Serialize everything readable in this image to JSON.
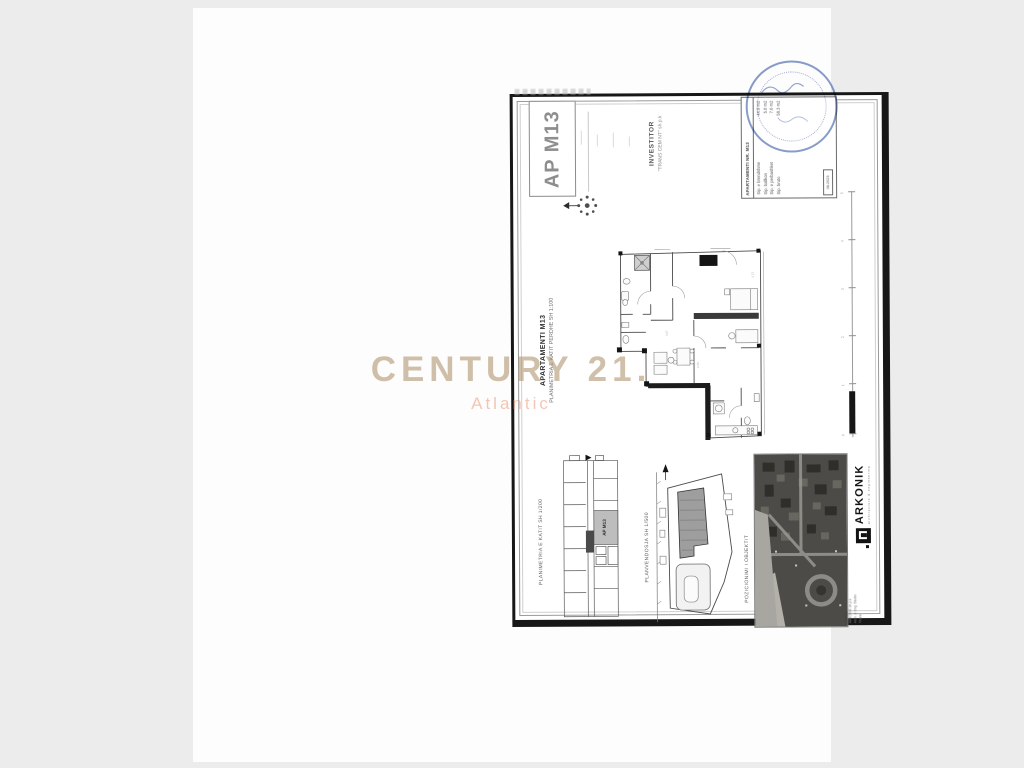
{
  "watermark": {
    "brand": "CENTURY 21.",
    "sub": "Atlantic"
  },
  "badge": "AP M13",
  "investor": {
    "label": "INVESTITOR",
    "name": "\"TRANS CEM NT\" sh.p.k"
  },
  "title_block": {
    "heading": "APARTAMENTI NR. M13",
    "rows": [
      {
        "label": "Sip. e brendshme",
        "value": "44.9 m2"
      },
      {
        "label": "Sip. ballkon",
        "value": "5.8 m2"
      },
      {
        "label": "Sip. e perbashket",
        "value": "7.6 m2"
      },
      {
        "label": "Sip. bruto",
        "value": "58.3 m2"
      }
    ],
    "date_box": "06.2023"
  },
  "main_plan": {
    "title": "APARTAMENTI M13",
    "subtitle": "PLANIMETRIA E KATIT PERDHE SH 1:100"
  },
  "scale_bar": {
    "labels": [
      "5",
      "4",
      "3",
      "2",
      "1",
      "0"
    ]
  },
  "key_plan": {
    "label": "PLANIMETRIA E KATIT SH 1/200",
    "unit_tag": "AP M13"
  },
  "site_plan": {
    "label": "PLANVENDOSJA SH 1/500"
  },
  "position_label": "POZICIONIMI I OBJEKTIT",
  "firm": {
    "logo": "ARKONIK",
    "tagline": "architecture & engineering",
    "credits_label": "PUNOI",
    "credit_lines": [
      "ARKONIK sh.p.k",
      "Arch. & Eng. Studio",
      "Tirane"
    ]
  },
  "colors": {
    "stamp": "#3e5fa8",
    "watermark_brand": "#b19670",
    "watermark_sub": "#e9987a"
  }
}
